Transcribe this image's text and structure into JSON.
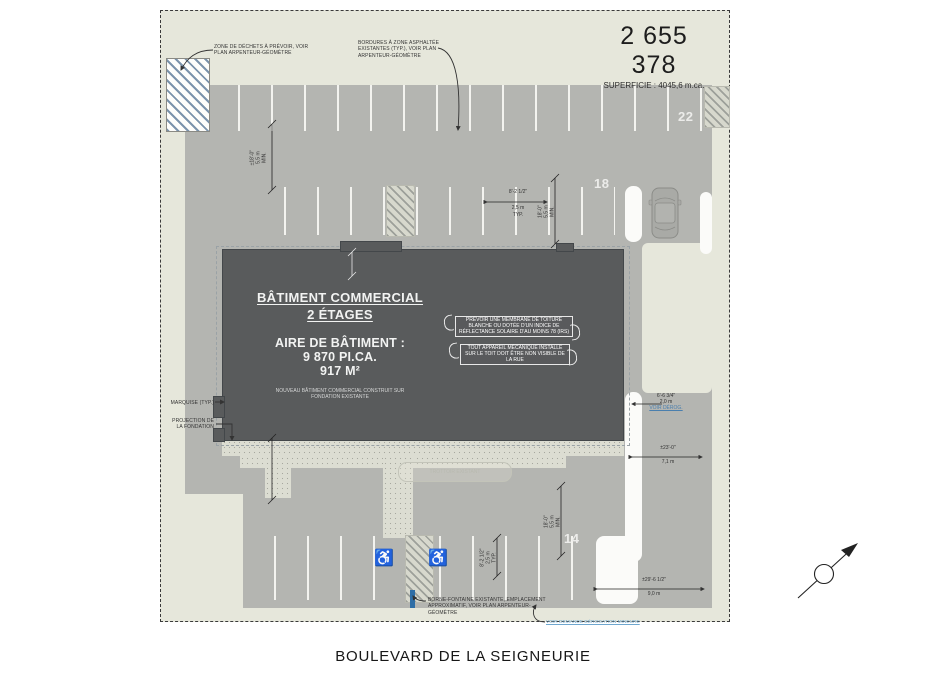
{
  "site": {
    "lot_number": "2 655 378",
    "superficie": "SUPERFICIE : 4045,6 m.ca."
  },
  "street": {
    "name": "BOULEVARD DE LA SEIGNEURIE"
  },
  "building": {
    "title": "BÂTIMENT COMMERCIAL",
    "subtitle": "2 ÉTAGES",
    "area_label": "AIRE DE BÂTIMENT :",
    "area_imperial": "9 870 PI.CA.",
    "area_metric": "917 M²",
    "footnote": "NOUVEAU BÂTIMENT COMMERCIAL CONSTRUIT SUR FONDATION EXISTANTE",
    "roof_note": "PRÉVOIR UNE MEMBRANE DE TOITURE BLANCHE OU DOTÉE D'UN INDICE DE RÉFLECTANCE SOLAIRE D'AU MOINS 78 (IRS)",
    "mech_note": "TOUT APPAREIL MÉCANIQUE INSTALLÉ SUR LE TOIT DOIT ÊTRE NON VISIBLE DE LA RUE"
  },
  "parking": {
    "count_top": "22",
    "count_right": "18",
    "count_bottom": "14",
    "handicap_icon": "♿"
  },
  "annotations": {
    "waste_zone": "ZONE DE DÉCHETS À PRÉVOIR, VOIR PLAN ARPENTEUR-GÉOMÈTRE",
    "curbs": "BORDURES À ZONE ASPHALTÉE EXISTANTES (TYP.), VOIR PLAN ARPENTEUR-GÉOMÈTRE",
    "marquise": "MARQUISE (TYP.)",
    "foundation_projection": "PROJECTION DE LA FONDATION",
    "existing_marker": "BORNE-FONTAINE EXISTANTE, EMPLACEMENT APPROXIMATIF, VOIR PLAN ARPENTEUR-GÉOMÈTRE",
    "derogation_link": "VOIR DEMANDE DÉROGATION MINEURE",
    "sidewalk_label": "TROTTOIR EXISTANT"
  },
  "dimensions": {
    "stall_width": {
      "imperial": "8'-2 1/2\"",
      "metric": "2,5 m",
      "qualifier": "TYP."
    },
    "aisle_top_left": {
      "imperial": "±18'-0\"",
      "metric": "5,5 m",
      "qualifier": "MIN."
    },
    "aisle_top_right": {
      "imperial": "18'-0\"",
      "metric": "5,5 m",
      "qualifier": "MIN."
    },
    "aisle_bottom": {
      "imperial": "18'-0\"",
      "metric": "5,5 m",
      "qualifier": "MIN."
    },
    "handicap_stall": {
      "imperial": "8'-2 1/2\"",
      "metric": "2,5 m",
      "qualifier": "TYP."
    },
    "side_setback": {
      "imperial": "6'-6 3/4\"",
      "metric": "2,0 m",
      "qualifier": "VOIR DÉROG."
    },
    "right_aisle": {
      "imperial": "±23'-0\"",
      "metric": "7,1 m"
    },
    "bottom_aisle": {
      "imperial": "±29'-6 1/2\"",
      "metric": "9,0 m"
    }
  },
  "colors": {
    "site_background": "#e6e7db",
    "asphalt": "#b4b5b1",
    "building": "#595b5c",
    "hydrant_blue": "#2f6ea6",
    "link_blue": "#6fa7cf"
  }
}
